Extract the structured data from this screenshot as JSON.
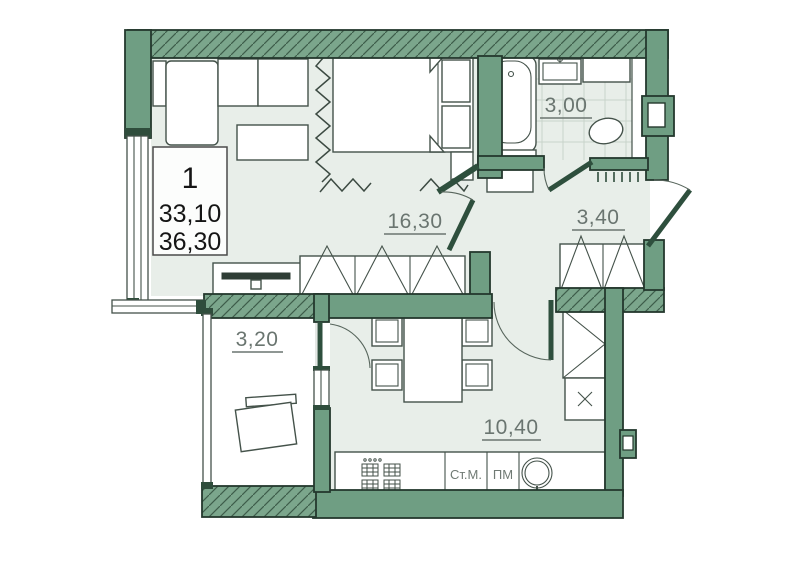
{
  "plan": {
    "title": "one-room apartment floor plan",
    "info_box": {
      "rooms_count": "1",
      "living_area": "33,10",
      "total_area": "36,30"
    },
    "rooms": {
      "living": {
        "label": "16,30"
      },
      "bathroom": {
        "label": "3,00"
      },
      "hallway": {
        "label": "3,40"
      },
      "balcony": {
        "label": "3,20"
      },
      "kitchen": {
        "label": "10,40"
      }
    },
    "appliances": {
      "washer": "Ст.М.",
      "dishwasher": "ПМ"
    },
    "colors": {
      "wall": "#6f9e83",
      "wall_outline": "#24382d",
      "wall_hatch_line": "#3d5c4a",
      "floor": "#e8eee9",
      "balcony_floor": "#ffffff",
      "tile_line": "#c8d4cb",
      "label_gray": "#6a7570",
      "info_text": "#151515"
    }
  }
}
